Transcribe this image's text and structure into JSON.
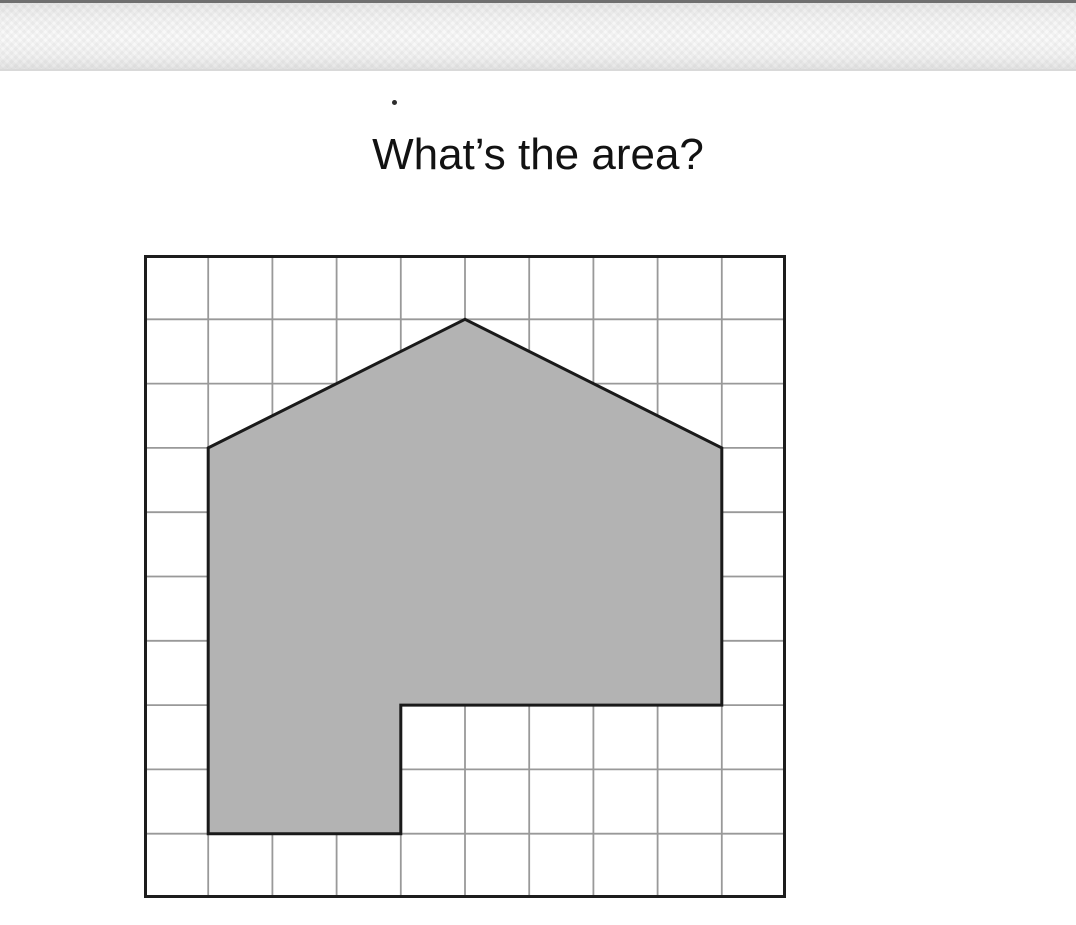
{
  "title": {
    "text": "What’s the area?"
  },
  "figure": {
    "grid": {
      "columns": 10,
      "rows": 10
    },
    "shape": {
      "type": "polygon",
      "vertices_grid_units": [
        [
          1,
          3
        ],
        [
          5,
          1
        ],
        [
          9,
          3
        ],
        [
          9,
          7
        ],
        [
          4,
          7
        ],
        [
          4,
          9
        ],
        [
          1,
          9
        ]
      ]
    },
    "colors": {
      "background": "#ffffff",
      "grid_line": "#999999",
      "grid_border": "#1d1d1d",
      "shape_fill": "#b3b3b3",
      "shape_stroke": "#1a1a1a"
    }
  }
}
